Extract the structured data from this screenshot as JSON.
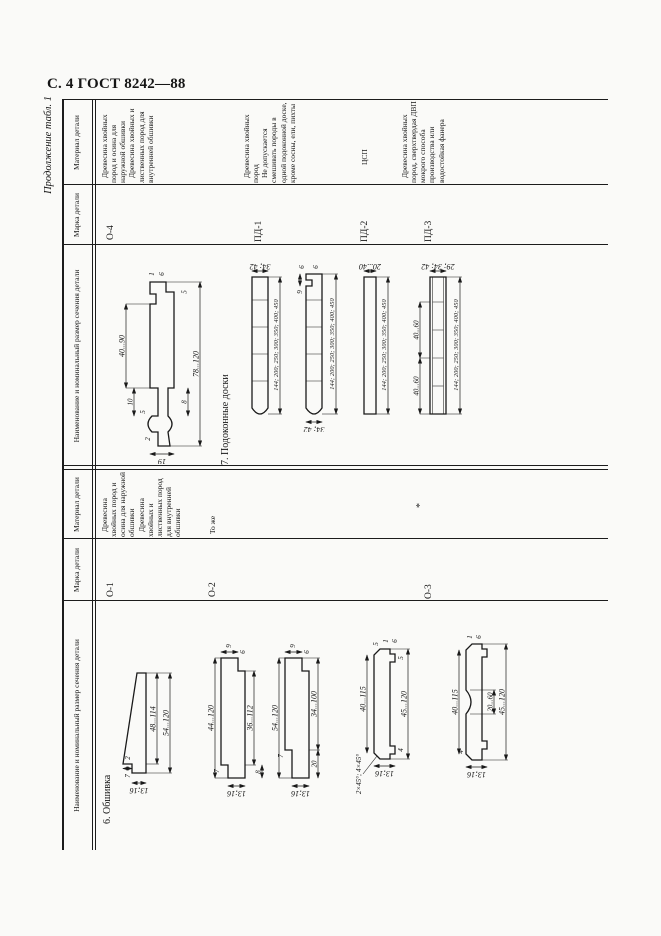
{
  "page": {
    "header": "С. 4 ГОСТ 8242—88",
    "continuation": "Продолжение табл. 1"
  },
  "columns": {
    "name": "Наименование и номинальный размер сечения детали",
    "mark": "Марка детали",
    "material": "Материал детали"
  },
  "sections": {
    "s6": "6. Обшивка",
    "s7": "7. Подоконные доски"
  },
  "rows": {
    "o1": {
      "mark": "О-1",
      "material": [
        "Древесина хвойных пород и осина для наружной обшивки",
        "Древесина хвойных и лиственных пород для внутренней обшивки"
      ]
    },
    "o2": {
      "mark": "О-2",
      "material": "То же"
    },
    "o3": {
      "mark": "О-3",
      "material": "*"
    },
    "o4": {
      "mark": "О-4",
      "material": [
        "Древесина хвойных пород и осина для наружной обшивки",
        "Древесина хвойных и лиственных пород для внутренней обшивки"
      ]
    },
    "pd1": {
      "mark": "ПД-1",
      "material": [
        "Древесина хвойных пород",
        "Не допускается смешивать породы в одной подоконной доске, кроме сосны, ели, пихты"
      ]
    },
    "pd2": {
      "mark": "ПД-2",
      "material": "ЦСП"
    },
    "pd3": {
      "mark": "ПД-3",
      "material": "Древесина хвойных пород, сверхтвердая ДВП мокрого способа производства или водостойкая фанера"
    }
  },
  "dims": {
    "o1": {
      "inner": "48...114",
      "outer": "54...120",
      "step": "7",
      "notch": "2",
      "t": "13;16"
    },
    "o2a": {
      "outer": "44...120",
      "inner": "36...112",
      "rebate": "8",
      "step": "9",
      "lip": "6",
      "top": "7",
      "t": "13;16"
    },
    "o2b": {
      "outer": "54...120",
      "inner": "34...100",
      "rebate": "20",
      "step": "9",
      "lip": "6",
      "top": "7",
      "t": "13;16"
    },
    "o3a": {
      "chamfer": "2×45°; 4×45°",
      "inner": "40...115",
      "outer": "45...120",
      "d4": "4",
      "d5": "5",
      "d1": "1",
      "d6": "6",
      "b5": "5",
      "t": "13;16"
    },
    "o3b": {
      "inner": "40...115",
      "outer": "45...120",
      "flute": "20...60",
      "d4": "4",
      "d1": "1",
      "d6": "6",
      "t": "13;16"
    },
    "o4": {
      "face": "40...90",
      "outer": "78...120",
      "t": "19",
      "d10": "10",
      "d5": "5",
      "d2": "2",
      "d1": "1",
      "d6": "6",
      "d8": "8",
      "b5": "5"
    },
    "pd1a": {
      "t": "34; 42",
      "widths": "144; 200; 250; 300; 350; 400; 450"
    },
    "pd1b": {
      "t": "34; 42",
      "widths": "144; 200; 250; 300; 350; 400; 450",
      "g6": "6",
      "g6b": "6",
      "d9": "9"
    },
    "pd2": {
      "t": "20...40",
      "widths": "144; 200; 250; 300; 350; 400; 450"
    },
    "pd3": {
      "t": "29; 34; 42",
      "widths": "144; 200; 250; 300; 350; 400; 450",
      "seg1": "40...60",
      "seg2": "40...60"
    }
  }
}
